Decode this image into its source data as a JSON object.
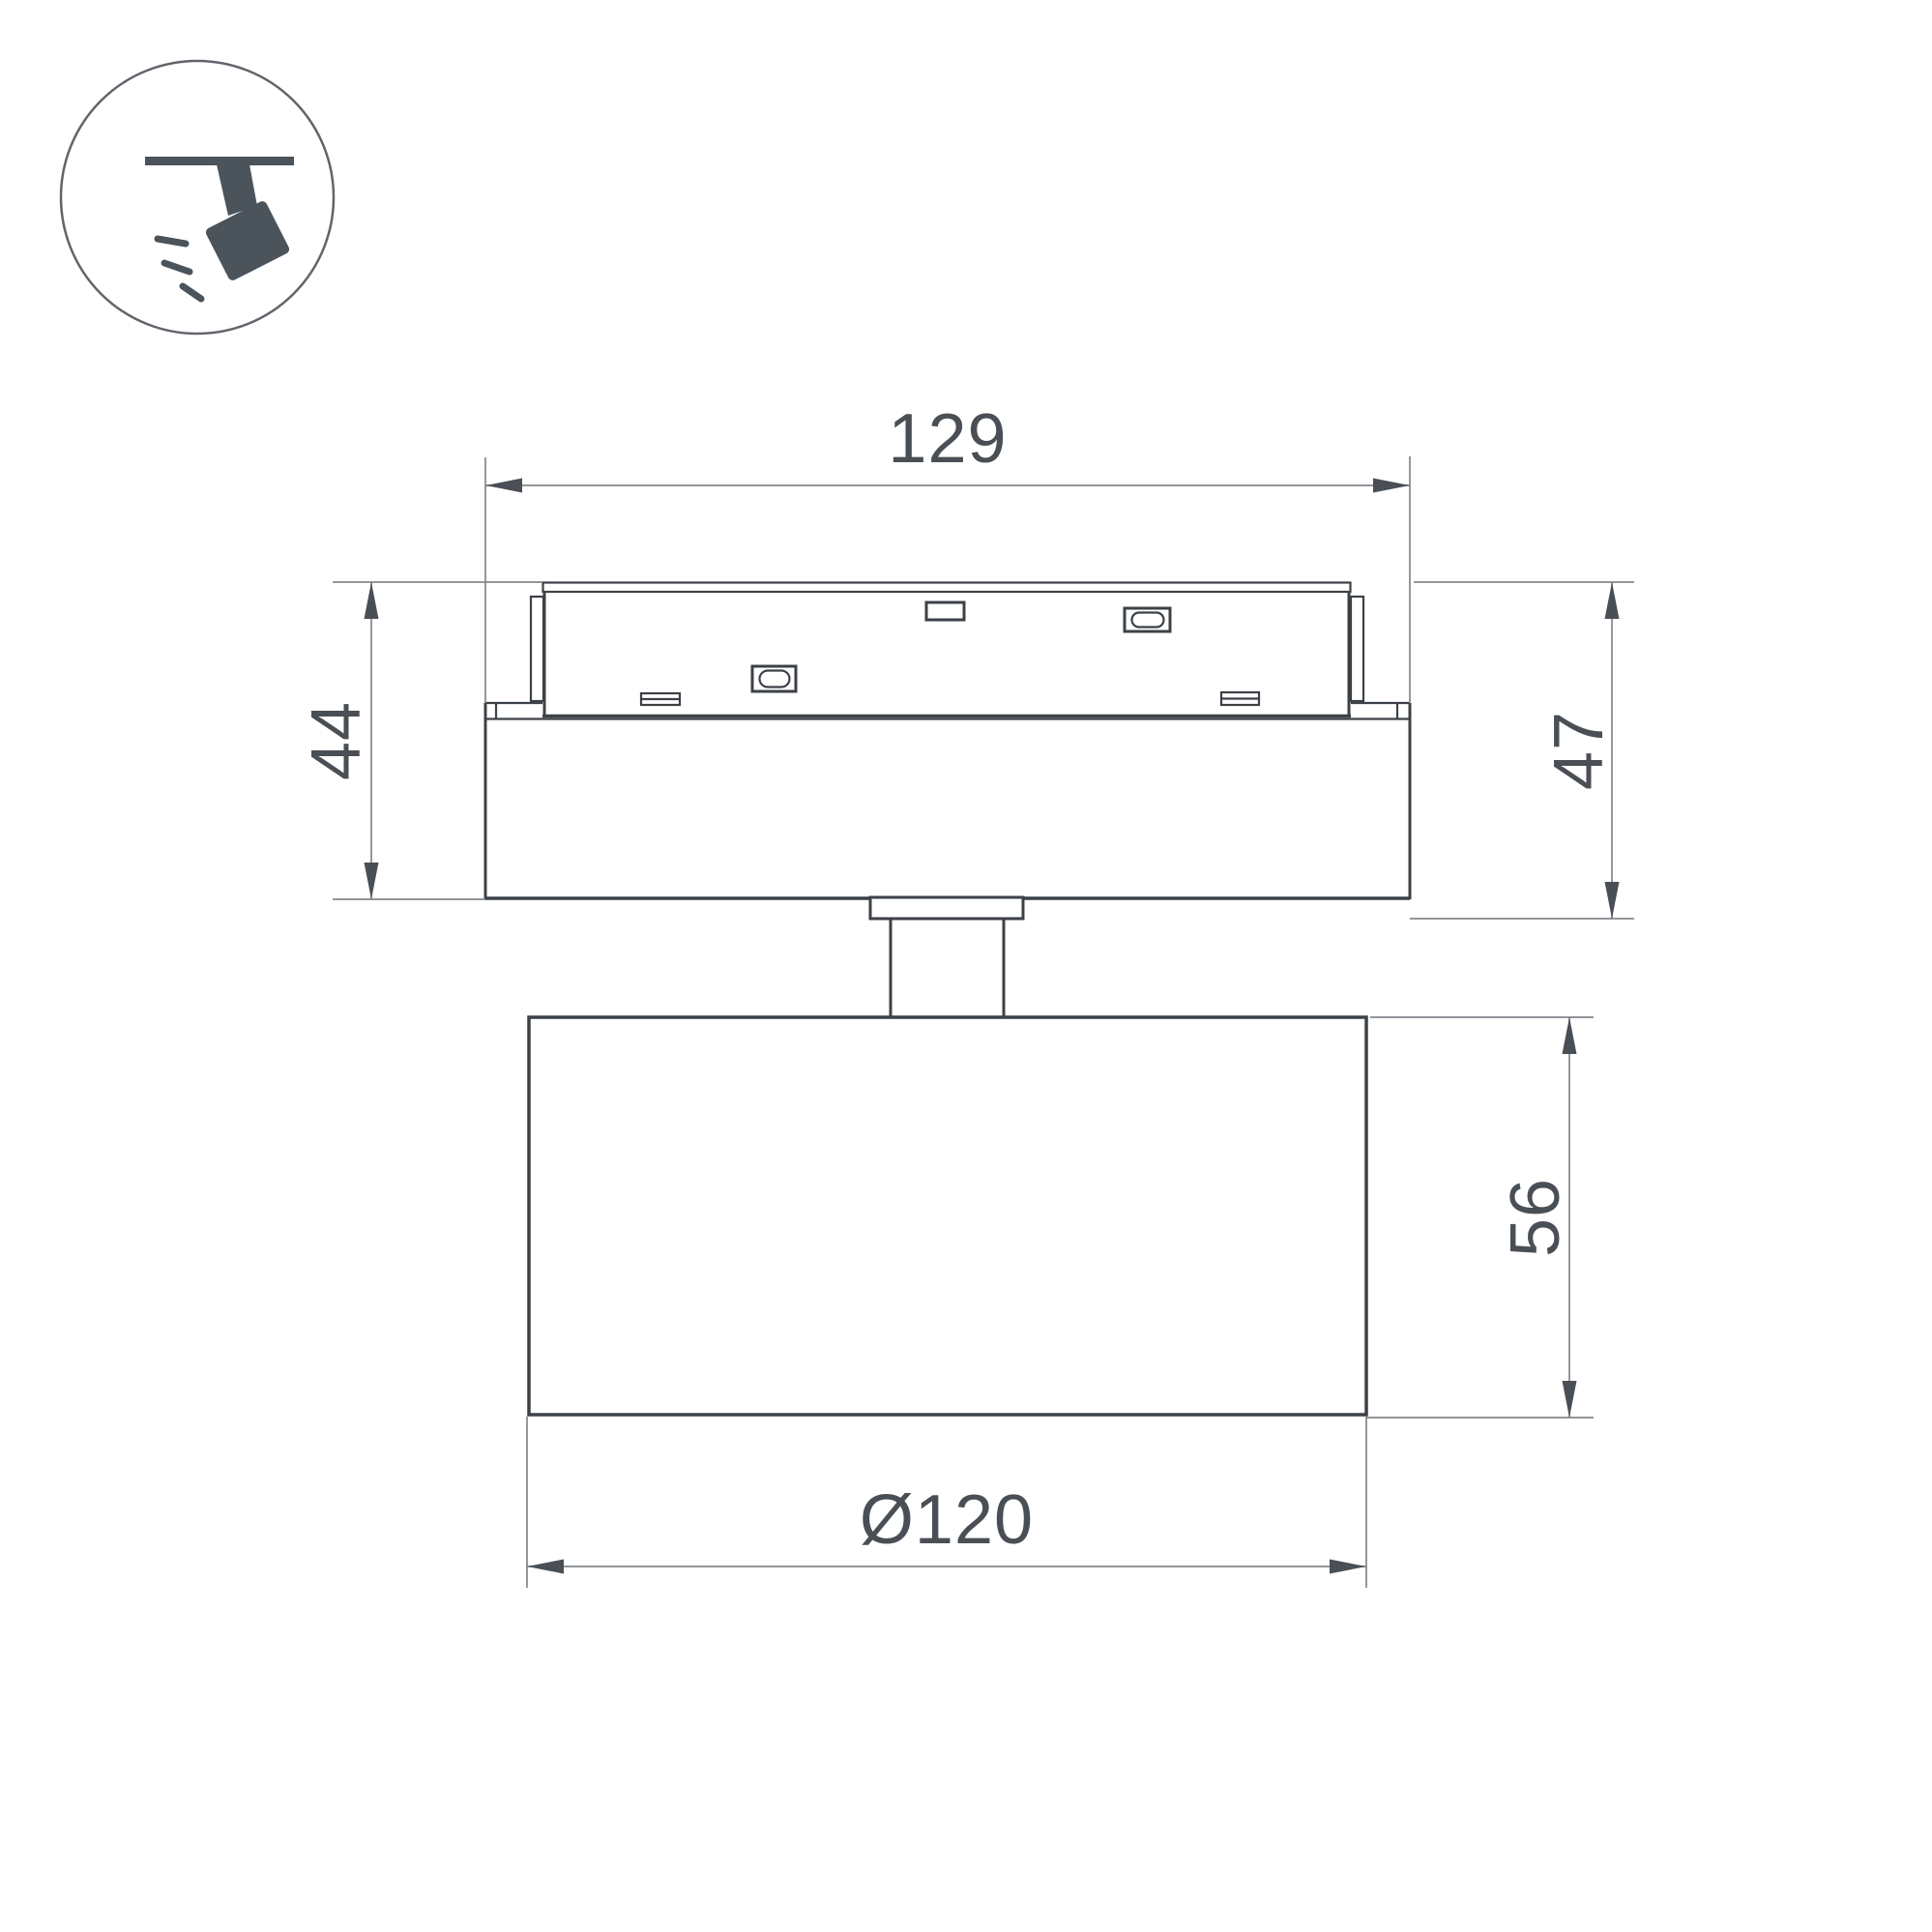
{
  "drawing": {
    "type": "technical-dimension-drawing",
    "subject": "magnetic-track-spotlight-side-view",
    "dimensions": {
      "track_length": "129",
      "adapter_height": "44",
      "base_height": "47",
      "head_height": "56",
      "head_diameter": "Ø120"
    },
    "icon": {
      "name": "track-spotlight-icon"
    },
    "colors": {
      "line": "#3c4147",
      "dim_line": "#82868b",
      "text": "#4a4f55",
      "icon": "#4b535b",
      "circle_stroke": "#60656b",
      "background": "#ffffff"
    }
  }
}
